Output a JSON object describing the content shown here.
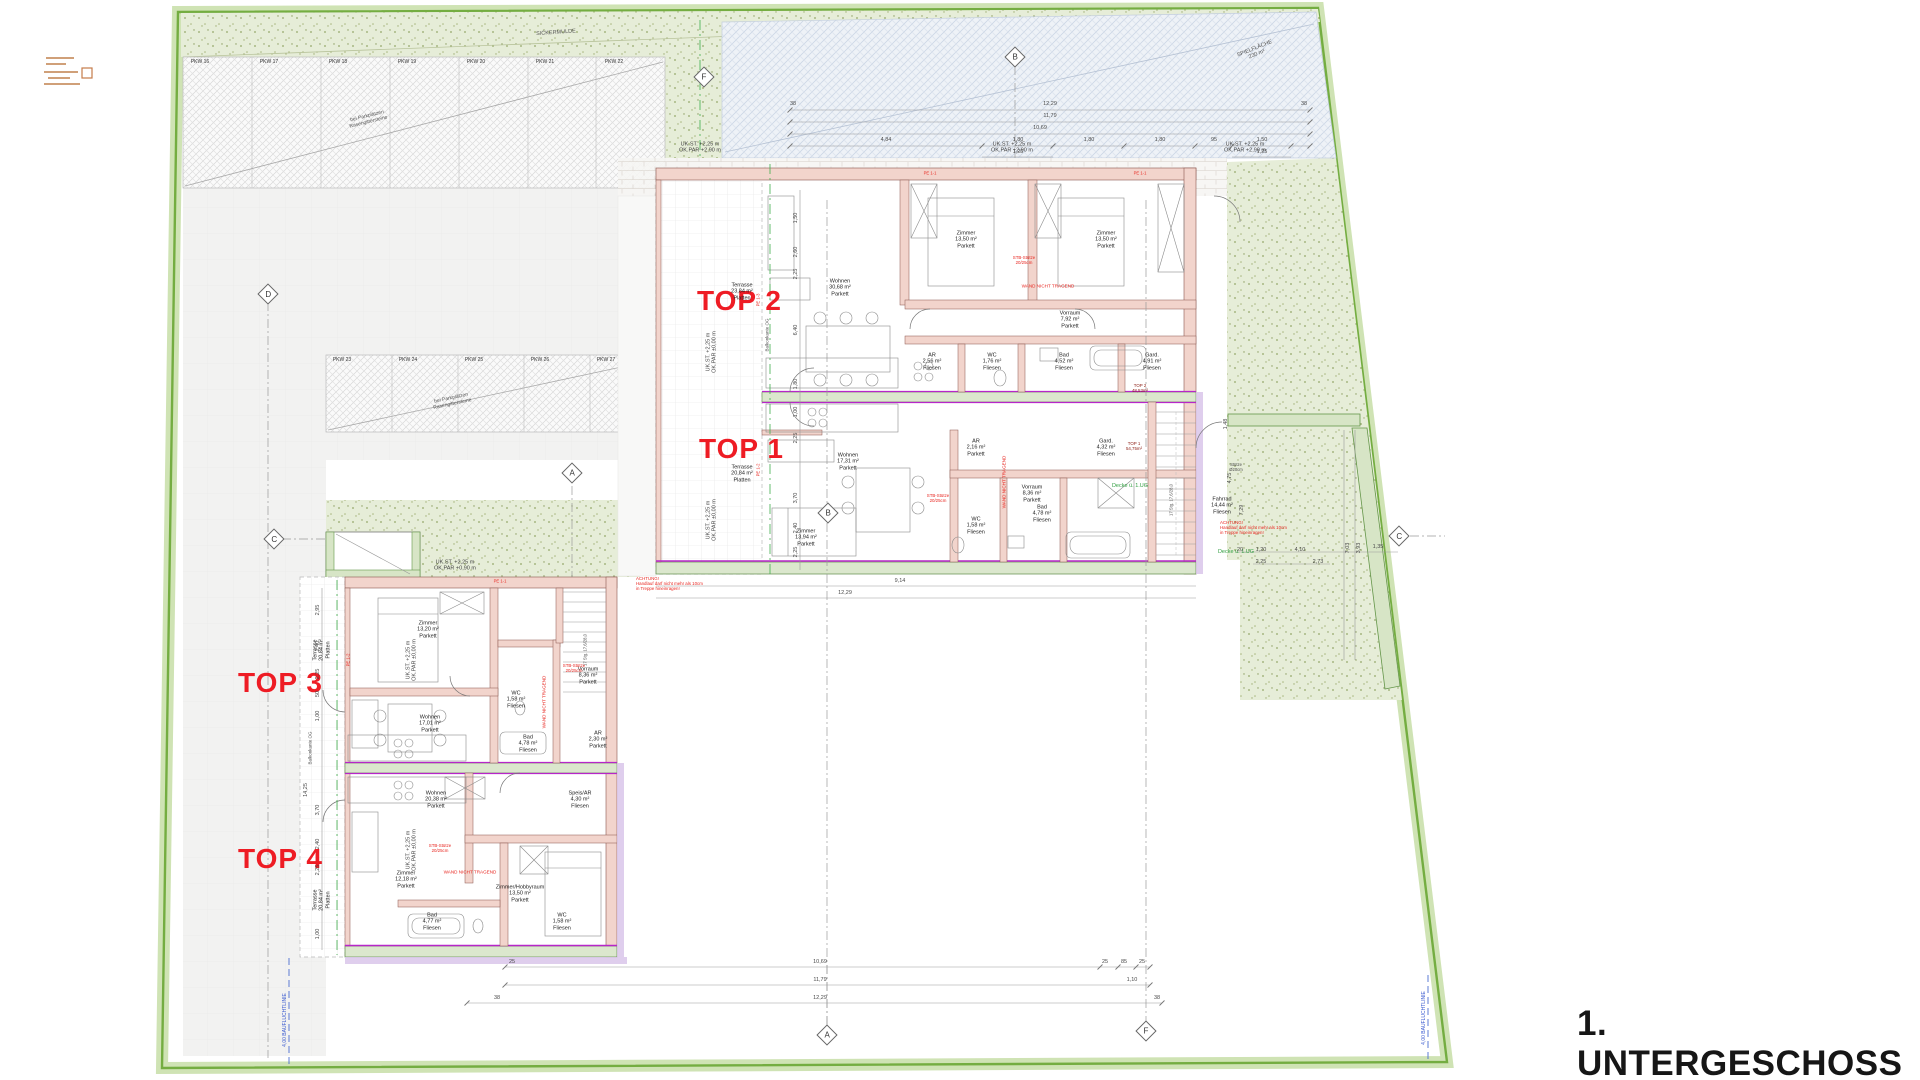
{
  "meta": {
    "title_label": "1. UNTERGESCHOSS"
  },
  "palette": {
    "boundary_green": "#74ad41",
    "accent_red": "#ee1c24",
    "wall_pink": "#f2d4cc",
    "wall_green": "#dbe7cd",
    "separation_magenta": "#b726c9",
    "play_area_blue": "#eef2f7",
    "note_blue": "#3b5bd0",
    "note_green": "#2f9e3f"
  },
  "top_units": [
    {
      "label": "TOP 2"
    },
    {
      "label": "TOP 1"
    },
    {
      "label": "TOP 3"
    },
    {
      "label": "TOP 4"
    }
  ],
  "section_markers": [
    {
      "letter": "D",
      "x": 268,
      "y": 294
    },
    {
      "letter": "C",
      "x": 274,
      "y": 539
    },
    {
      "letter": "A",
      "x": 572,
      "y": 473
    },
    {
      "letter": "B",
      "x": 1015,
      "y": 57
    },
    {
      "letter": "F",
      "x": 704,
      "y": 77
    },
    {
      "letter": "B",
      "x": 828,
      "y": 513
    },
    {
      "letter": "C",
      "x": 1399,
      "y": 536
    },
    {
      "letter": "A",
      "x": 827,
      "y": 1035
    },
    {
      "letter": "F",
      "x": 1146,
      "y": 1031
    }
  ],
  "parking": {
    "area1": {
      "stalls": [
        "PKW 16",
        "PKW 17",
        "PKW 18",
        "PKW 19",
        "PKW 20",
        "PKW 21",
        "PKW 22"
      ],
      "label_y": 63,
      "label_x0": 200,
      "pitch": 69,
      "note": {
        "t": "bei Parkplätzen\nRasengittersteine",
        "x": 368,
        "y": 120,
        "r": -14
      }
    },
    "area2": {
      "stalls": [
        "PKW 23",
        "PKW 24",
        "PKW 25",
        "PKW 26",
        "PKW 27"
      ],
      "label_y": 361,
      "label_x0": 342,
      "pitch": 66,
      "note": {
        "t": "bei Parkplätzen\nRasengittersteine",
        "x": 452,
        "y": 402,
        "r": -12
      }
    }
  },
  "site_texts": [
    {
      "t": "SICKERMULDE",
      "x": 556,
      "y": 33,
      "r": -4,
      "s": 5.5
    },
    {
      "t": "SPIELFLÄCHE\n230 m²",
      "x": 1256,
      "y": 52,
      "r": -22,
      "s": 5.5
    },
    {
      "t": "4,00 BAUFLUCHTLINIE",
      "x": 286,
      "y": 1020,
      "r": -90,
      "s": 5,
      "c": "#3b5bd0"
    },
    {
      "t": "4,00 BAUFLUCHTLINIE",
      "x": 1425,
      "y": 1018,
      "r": -90,
      "s": 5,
      "c": "#3b5bd0"
    },
    {
      "t": "Balkonkante OG",
      "x": 767,
      "y": 335,
      "r": -90,
      "s": 4.5
    },
    {
      "t": "Balkonkante OG",
      "x": 310,
      "y": 748,
      "r": -90,
      "s": 4.5
    }
  ],
  "elevation_notes": [
    {
      "t": "UK.ST. +2,25 m\nOK.PAR +2,90 m",
      "x": 700,
      "y": 148
    },
    {
      "t": "UK.ST. +2,25 m\nOK.PAR +2,90 m",
      "x": 1012,
      "y": 148
    },
    {
      "t": "UK.ST. +2,25 m\nOK.PAR +2,90 m",
      "x": 1245,
      "y": 148
    },
    {
      "t": "UK.ST. +2,25 m\nOK.PAR ±0,00 m",
      "x": 712,
      "y": 352,
      "r": -90
    },
    {
      "t": "UK.ST. +2,25 m\nOK.PAR ±0,00 m",
      "x": 712,
      "y": 520,
      "r": -90
    },
    {
      "t": "UK.ST. +2,25 m\nOK.PAR +0,90 m",
      "x": 455,
      "y": 566
    },
    {
      "t": "UK.ST. +2,25 m\nOK.PAR ±0,00 m",
      "x": 412,
      "y": 660,
      "r": -90
    },
    {
      "t": "UK.ST. +2,25 m\nOK.PAR ±0,00 m",
      "x": 412,
      "y": 850,
      "r": -90
    }
  ],
  "rooms": [
    {
      "t": "Terrasse\n23,84 m²\nPlatten",
      "x": 742,
      "y": 292
    },
    {
      "t": "Wohnen\n30,68 m²\nParkett",
      "x": 840,
      "y": 288
    },
    {
      "t": "Zimmer\n13,50 m²\nParkett",
      "x": 966,
      "y": 240
    },
    {
      "t": "Zimmer\n13,50 m²\nParkett",
      "x": 1106,
      "y": 240
    },
    {
      "t": "Vorraum\n7,92 m²\nParkett",
      "x": 1070,
      "y": 320
    },
    {
      "t": "AR\n2,56 m²\nFliesen",
      "x": 932,
      "y": 362
    },
    {
      "t": "WC\n1,76 m²\nFliesen",
      "x": 992,
      "y": 362
    },
    {
      "t": "Bad\n4,52 m²\nFliesen",
      "x": 1064,
      "y": 362
    },
    {
      "t": "Gard.\n4,91 m²\nFliesen",
      "x": 1152,
      "y": 362
    },
    {
      "t": "Terrasse\n20,84 m²\nPlatten",
      "x": 742,
      "y": 474
    },
    {
      "t": "Wohnen\n17,31 m²\nParkett",
      "x": 848,
      "y": 462
    },
    {
      "t": "Zimmer\n13,94 m²\nParkett",
      "x": 806,
      "y": 538
    },
    {
      "t": "AR\n2,16 m²\nParkett",
      "x": 976,
      "y": 448
    },
    {
      "t": "Gard.\n4,32 m²\nFliesen",
      "x": 1106,
      "y": 448
    },
    {
      "t": "Vorraum\n8,36 m²\nParkett",
      "x": 1032,
      "y": 494
    },
    {
      "t": "WC\n1,58 m²\nFliesen",
      "x": 976,
      "y": 526
    },
    {
      "t": "Bad\n4,78 m²\nFliesen",
      "x": 1042,
      "y": 514
    },
    {
      "t": "Fahrrad\n14,44 m²\nFliesen",
      "x": 1222,
      "y": 506
    },
    {
      "t": "Zimmer\n13,20 m²\nParkett",
      "x": 428,
      "y": 630
    },
    {
      "t": "Wohnen\n17,01 m²\nParkett",
      "x": 430,
      "y": 724
    },
    {
      "t": "Vorraum\n8,36 m²\nParkett",
      "x": 588,
      "y": 676
    },
    {
      "t": "AR\n2,30 m²\nParkett",
      "x": 598,
      "y": 740
    },
    {
      "t": "WC\n1,58 m²\nFliesen",
      "x": 516,
      "y": 700
    },
    {
      "t": "Bad\n4,78 m²\nFliesen",
      "x": 528,
      "y": 744
    },
    {
      "t": "Wohnen\n20,38 m²\nParkett",
      "x": 436,
      "y": 800
    },
    {
      "t": "Speis/AR\n4,30 m²\nFliesen",
      "x": 580,
      "y": 800
    },
    {
      "t": "Zimmer\n12,18 m²\nParkett",
      "x": 406,
      "y": 880
    },
    {
      "t": "Zimmer/Hobbyraum\n13,50 m²\nParkett",
      "x": 520,
      "y": 894
    },
    {
      "t": "Bad\n4,77 m²\nFliesen",
      "x": 432,
      "y": 922
    },
    {
      "t": "WC\n1,58 m²\nFliesen",
      "x": 562,
      "y": 922
    },
    {
      "t": "Terrasse\n20,84 m²\nPlatten",
      "x": 322,
      "y": 650,
      "r": -90
    },
    {
      "t": "Terrasse\n20,84 m²\nPlatten",
      "x": 322,
      "y": 900,
      "r": -90
    }
  ],
  "red_notes": [
    {
      "t": "WAND NICHT TRAGEND",
      "x": 1048,
      "y": 286,
      "s": 4.6
    },
    {
      "t": "WAND NICHT TRAGEND",
      "x": 1004,
      "y": 482,
      "s": 4.6,
      "r": -90
    },
    {
      "t": "WAND NICHT TRAGEND",
      "x": 544,
      "y": 702,
      "s": 4.6,
      "r": -90
    },
    {
      "t": "WAND NICHT TRAGEND",
      "x": 470,
      "y": 872,
      "s": 4.6
    },
    {
      "t": "STB-Stütze\n20/25cm",
      "x": 1024,
      "y": 260,
      "s": 4.4
    },
    {
      "t": "STB-Stütze\n20/25cm",
      "x": 938,
      "y": 498,
      "s": 4.4
    },
    {
      "t": "STB-Stütze\n20/25cm",
      "x": 574,
      "y": 668,
      "s": 4.4
    },
    {
      "t": "STB-Stütze\n20/25cm",
      "x": 440,
      "y": 848,
      "s": 4.4
    },
    {
      "t": "ACHTUNG!\nHandlauf darf nicht mehr als 10cm\nin Treppe hineinragen!",
      "x": 1220,
      "y": 528,
      "s": 4.4,
      "a": "l"
    },
    {
      "t": "ACHTUNG!\nHandlauf darf nicht mehr als 10cm\nin Treppe hineinragen!",
      "x": 636,
      "y": 584,
      "s": 4.4,
      "a": "l"
    },
    {
      "t": "PE 1-1",
      "x": 930,
      "y": 174,
      "s": 4.2
    },
    {
      "t": "PE 1-1",
      "x": 1140,
      "y": 174,
      "s": 4.2
    },
    {
      "t": "PE 1-3",
      "x": 759,
      "y": 300,
      "s": 4.2,
      "r": -90
    },
    {
      "t": "PE 1-2",
      "x": 759,
      "y": 470,
      "s": 4.2,
      "r": -90
    },
    {
      "t": "PE 1-1",
      "x": 500,
      "y": 582,
      "s": 4.2
    },
    {
      "t": "PE 1-2",
      "x": 349,
      "y": 660,
      "s": 4.2,
      "r": -90
    },
    {
      "t": "TOP 2\n48,53m²",
      "x": 1140,
      "y": 388,
      "s": 4.4,
      "c": "#8a1a10"
    },
    {
      "t": "TOP 1\n54,75m²",
      "x": 1134,
      "y": 446,
      "s": 4.4,
      "c": "#8a1a10"
    }
  ],
  "green_notes": [
    {
      "t": "Decke ü. 1.UG",
      "x": 1130,
      "y": 486
    },
    {
      "t": "Decke ü. 1.UG",
      "x": 1236,
      "y": 552
    }
  ],
  "dims": [
    {
      "t": "12,29",
      "x": 1050,
      "y": 104
    },
    {
      "t": "11,79",
      "x": 1050,
      "y": 116
    },
    {
      "t": "10,69",
      "x": 1040,
      "y": 128
    },
    {
      "t": "4,84",
      "x": 886,
      "y": 140
    },
    {
      "t": "1,80",
      "x": 1018,
      "y": 140
    },
    {
      "t": "1,80",
      "x": 1089,
      "y": 140
    },
    {
      "t": "1,80",
      "x": 1160,
      "y": 140
    },
    {
      "t": "95",
      "x": 1214,
      "y": 140
    },
    {
      "t": "1,50",
      "x": 1262,
      "y": 140
    },
    {
      "t": "1,25",
      "x": 1018,
      "y": 152
    },
    {
      "t": "1,25",
      "x": 1262,
      "y": 152
    },
    {
      "t": "38",
      "x": 793,
      "y": 104
    },
    {
      "t": "38",
      "x": 1304,
      "y": 104
    },
    {
      "t": "9,14",
      "x": 900,
      "y": 581
    },
    {
      "t": "12,29",
      "x": 845,
      "y": 593
    },
    {
      "t": "10,69",
      "x": 820,
      "y": 962
    },
    {
      "t": "11,79",
      "x": 820,
      "y": 980
    },
    {
      "t": "12,29",
      "x": 820,
      "y": 998
    },
    {
      "t": "25",
      "x": 512,
      "y": 962
    },
    {
      "t": "25",
      "x": 1105,
      "y": 962
    },
    {
      "t": "85",
      "x": 1124,
      "y": 962
    },
    {
      "t": "25",
      "x": 1142,
      "y": 962
    },
    {
      "t": "1,10",
      "x": 1132,
      "y": 980
    },
    {
      "t": "38",
      "x": 497,
      "y": 998
    },
    {
      "t": "38",
      "x": 1157,
      "y": 998
    },
    {
      "t": "2,95",
      "x": 318,
      "y": 610,
      "r": -90
    },
    {
      "t": "2,40",
      "x": 318,
      "y": 646,
      "r": -90
    },
    {
      "t": "2,25",
      "x": 318,
      "y": 674,
      "r": -90
    },
    {
      "t": "50",
      "x": 318,
      "y": 694,
      "r": -90
    },
    {
      "t": "1,00",
      "x": 318,
      "y": 716,
      "r": -90
    },
    {
      "t": "3,70",
      "x": 318,
      "y": 810,
      "r": -90
    },
    {
      "t": "2,40",
      "x": 318,
      "y": 844,
      "r": -90
    },
    {
      "t": "2,25",
      "x": 318,
      "y": 870,
      "r": -90
    },
    {
      "t": "1,00",
      "x": 318,
      "y": 934,
      "r": -90
    },
    {
      "t": "14,25",
      "x": 306,
      "y": 790,
      "r": -90
    },
    {
      "t": "1,50",
      "x": 796,
      "y": 218,
      "r": -90
    },
    {
      "t": "2,60",
      "x": 796,
      "y": 252,
      "r": -90
    },
    {
      "t": "2,25",
      "x": 796,
      "y": 274,
      "r": -90
    },
    {
      "t": "6,40",
      "x": 796,
      "y": 330,
      "r": -90
    },
    {
      "t": "1,80",
      "x": 796,
      "y": 384,
      "r": -90
    },
    {
      "t": "1,00",
      "x": 796,
      "y": 412,
      "r": -90
    },
    {
      "t": "2,25",
      "x": 796,
      "y": 438,
      "r": -90
    },
    {
      "t": "3,70",
      "x": 796,
      "y": 498,
      "r": -90
    },
    {
      "t": "2,40",
      "x": 796,
      "y": 528,
      "r": -90
    },
    {
      "t": "2,25",
      "x": 796,
      "y": 552,
      "r": -90
    },
    {
      "t": "20",
      "x": 1240,
      "y": 550
    },
    {
      "t": "1,20",
      "x": 1261,
      "y": 550
    },
    {
      "t": "2,25",
      "x": 1261,
      "y": 562
    },
    {
      "t": "4,10",
      "x": 1300,
      "y": 550
    },
    {
      "t": "2,73",
      "x": 1318,
      "y": 562
    },
    {
      "t": "1,35",
      "x": 1378,
      "y": 547
    },
    {
      "t": "7,03",
      "x": 1348,
      "y": 548,
      "r": -90
    },
    {
      "t": "3,93",
      "x": 1359,
      "y": 548,
      "r": -90
    },
    {
      "t": "4,75",
      "x": 1230,
      "y": 478,
      "r": -90
    },
    {
      "t": "7,29",
      "x": 1242,
      "y": 510,
      "r": -90
    },
    {
      "t": "1,48",
      "x": 1226,
      "y": 424,
      "r": -90
    },
    {
      "t": "17 Stg. 17,6/28,0",
      "x": 1172,
      "y": 500,
      "r": -90,
      "s": 4.2
    },
    {
      "t": "17 Stg. 17,6/28,0",
      "x": 586,
      "y": 650,
      "r": -90,
      "s": 4.2
    },
    {
      "t": "Stütze\nØ20cm",
      "x": 1236,
      "y": 468,
      "s": 4.2
    }
  ]
}
